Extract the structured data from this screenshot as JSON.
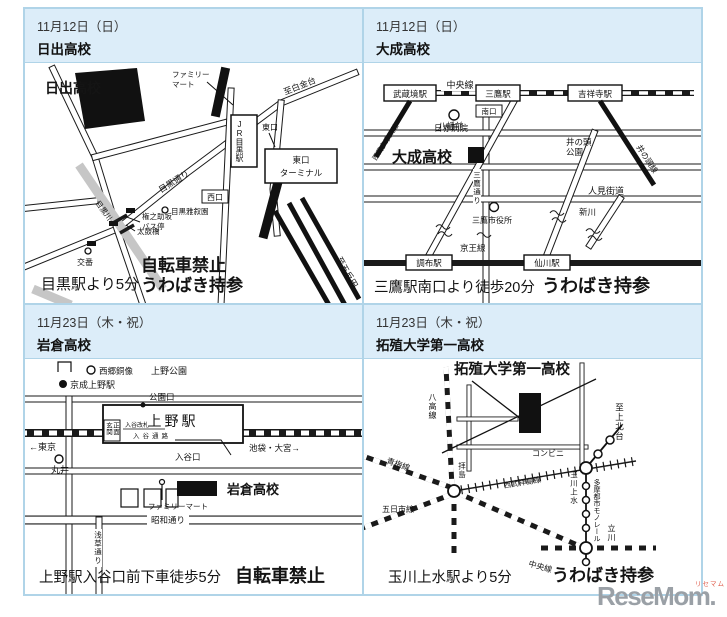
{
  "theme": {
    "frame_color": "#b0d4e8",
    "header_bg": "#dcedf9",
    "map_ink": "#1a1a1a",
    "river_gray": "#c6c6c6",
    "logo_gray": "#9aa0a6",
    "logo_accent": "#e0604f"
  },
  "panels": [
    {
      "date": "11月12日（日）",
      "school": "日出高校",
      "caption": "目黒駅より5分",
      "note_line1": "自転車禁止",
      "note_line2": "うわばき持参",
      "labels": {
        "school_on_map": "日出高校",
        "familymart_1": "ファミリー",
        "familymart_2": "マート",
        "to_shirokanedai": "至白金台",
        "meguro_dori": "目黒通り",
        "station": "JR目黒駅",
        "east_exit": "東口",
        "east_terminal_1": "東口",
        "east_terminal_2": "ターミナル",
        "west_exit": "西口",
        "bus_stop_1": "権之助坂",
        "bus_stop_2": "バス停",
        "koban": "交番",
        "river": "目黒川",
        "taiko_bridge": "太鼓橋",
        "gajoen": "目黒雅叙園",
        "to_gotanda": "至五反田"
      }
    },
    {
      "date": "11月12日（日）",
      "school": "大成高校",
      "caption": "三鷹駅南口より徒歩20分",
      "note_line1": "うわばき持参",
      "labels": {
        "chuo_line": "中央線",
        "musashisakai": "武蔵境駅",
        "mitaka": "三鷹駅",
        "kichijoji": "吉祥寺駅",
        "minamiguchi": "南口",
        "seibu_tamagawa": "西武多摩川線",
        "nisseki": "日赤病院",
        "inokashira_park_1": "井の頭",
        "inokashira_park_2": "公園",
        "inokashira_line": "井の頭線",
        "mitaka_dori": "三鷹通り",
        "hachiman_mae": "八幡前",
        "school_on_map": "大成高校",
        "hitomi_kaido": "人見街道",
        "shinkawa": "新川",
        "city_hall": "三鷹市役所",
        "keio_line": "京王線",
        "chofu": "調布駅",
        "sengawa": "仙川駅"
      }
    },
    {
      "date": "11月23日（木・祝）",
      "school": "岩倉高校",
      "caption": "上野駅入谷口前下車徒歩5分",
      "note_line1": "自転車禁止",
      "labels": {
        "saigo": "西郷銅像",
        "keisei_ueno": "京成上野駅",
        "ueno_park": "上野公園",
        "koen_guchi": "公園口",
        "ueno_station": "上野駅",
        "genkan_right": "正面",
        "genkan_left": "玄関",
        "iriya_kaisatsu": "入谷改札",
        "iriya_tsuro": "入谷通路",
        "to_tokyo": "←東京",
        "marui": "丸井",
        "ikebukuro_omiya": "池袋・大宮→",
        "iriya_guchi": "入谷口",
        "school_on_map": "岩倉高校",
        "familymart": "ファミリーマート",
        "showa_dori": "昭和通り",
        "asakusa_dori": "浅草通り"
      }
    },
    {
      "date": "11月23日（木・祝）",
      "school": "拓殖大学第一高校",
      "caption": "玉川上水駅より5分",
      "note_line1": "うわばき持参",
      "labels": {
        "school_on_map": "拓殖大学第一高校",
        "hachiko_line": "八高線",
        "ome_line": "青梅線",
        "itsukaichi_line": "五日市線",
        "seibu_haijima": "西武拝島線",
        "haijima": "拝島",
        "conbini": "コンビニ",
        "monorail": "多摩都市モノレール",
        "tamagawa_josui": "玉川上水",
        "to_kamikitadai": "至上北台",
        "tachikawa": "立川",
        "chuo_line": "中央線"
      }
    }
  ],
  "logo": {
    "text": "ReseMom.",
    "ruby": "リセマム"
  }
}
